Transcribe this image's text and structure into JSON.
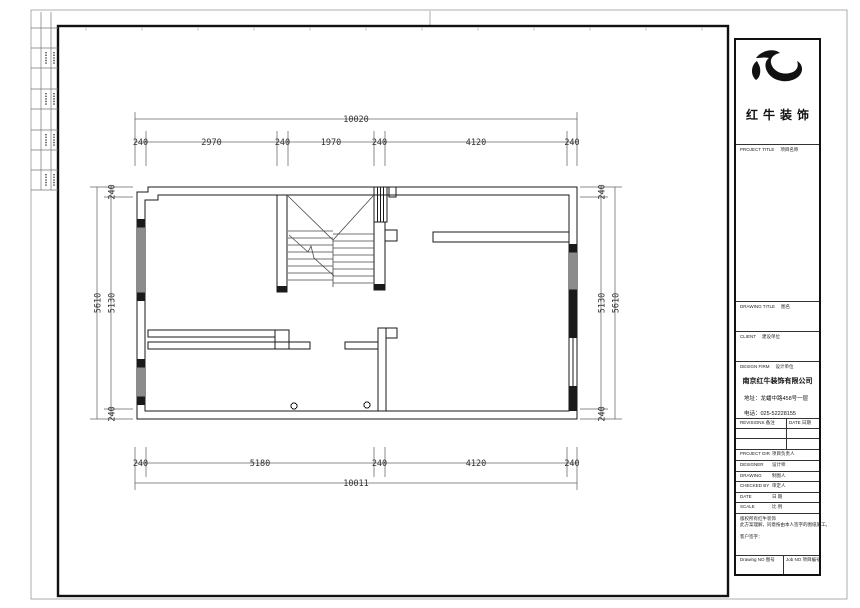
{
  "dims": {
    "top": {
      "overall": "10020",
      "chain": [
        "240",
        "2970",
        "240",
        "1970",
        "240",
        "4120",
        "240"
      ]
    },
    "bottom": {
      "overall": "10011",
      "chain": [
        "240",
        "5180",
        "240",
        "4120",
        "240"
      ]
    },
    "left": {
      "overall": "5610",
      "chain": [
        "240",
        "5130",
        "240"
      ]
    },
    "right": {
      "overall": "5610",
      "chain": [
        "240",
        "5130",
        "240"
      ]
    }
  },
  "title_block": {
    "brand": {
      "logo": "bull-swoosh-logo",
      "name": "红牛装饰"
    },
    "sections": {
      "project_title": {
        "en": "PROJECT TITLE",
        "zh": "项目名称"
      },
      "drawing_title": {
        "en": "DRAWING TITLE",
        "zh": "图名"
      },
      "client": {
        "en": "CLIENT",
        "zh": "建设单位"
      },
      "design_firm": {
        "en": "DESIGN FIRM",
        "zh": "设计单位"
      }
    },
    "company": {
      "name": "南京红牛装饰有限公司",
      "address": "地址：龙蟠中路458号一层",
      "phone": "电话：025-52228155"
    },
    "revisions": {
      "col1": "REVISIONS 备注",
      "col2": "DATE 日期"
    },
    "staff": [
      {
        "en": "PROJECT DIR",
        "zh": "项目负责人"
      },
      {
        "en": "DESIGNER",
        "zh": "设计师"
      },
      {
        "en": "DRAWING",
        "zh": "制图人"
      },
      {
        "en": "CHECKED BY",
        "zh": "审定人"
      },
      {
        "en": "DATE",
        "zh": "日 期"
      },
      {
        "en": "SCALE",
        "zh": "比 例"
      }
    ],
    "disclaimer": {
      "line1": "版权所有红牛装饰",
      "line2": "此方案理解，同意按由本人签字的图纸施工。",
      "line3": "客户签字："
    },
    "footer": {
      "drawing_no": "Drawing NO 图号",
      "job_no": "Job NO 项目编号"
    }
  },
  "colors": {
    "line": "#1a1a1a",
    "dim_line": "#666",
    "frame": "#111"
  }
}
